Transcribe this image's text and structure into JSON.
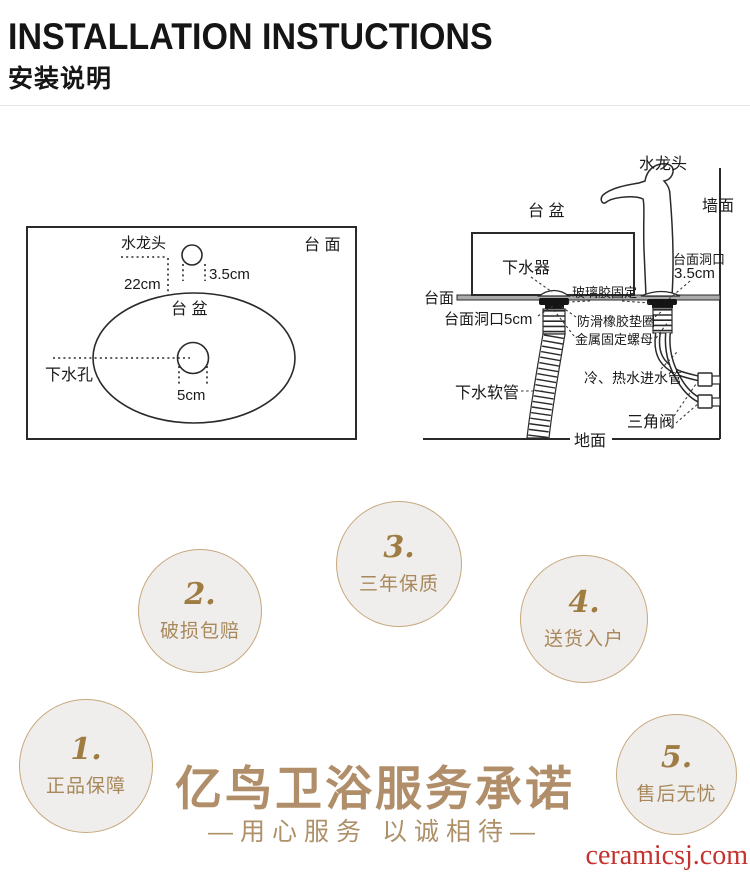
{
  "header": {
    "title": "INSTALLATION INSTUCTIONS",
    "subtitle": "安装说明"
  },
  "left_diagram": {
    "countertop_label": "台 面",
    "faucet_label": "水龙头",
    "faucet_hole_size": "3.5cm",
    "faucet_distance": "22cm",
    "basin_label": "台 盆",
    "drain_label": "下水孔",
    "drain_hole_size": "5cm"
  },
  "right_diagram": {
    "faucet_label": "水龙头",
    "wall_label": "墙面",
    "basin_label": "台 盆",
    "drain_fitting_label": "下水器",
    "glue_label": "玻璃胶固定",
    "countertop_label": "台面",
    "faucet_hole_label_line1": "台面洞口",
    "faucet_hole_label_line2": "3.5cm",
    "drain_hole_label": "台面洞口5cm",
    "washer_label": "防滑橡胶垫圈",
    "nut_label": "金属固定螺母",
    "drain_hose_label": "下水软管",
    "supply_pipe_label": "冷、热水进水管",
    "valve_label": "三角阀",
    "floor_label": "地面"
  },
  "badges": [
    {
      "num": "1.",
      "label": "正品保障"
    },
    {
      "num": "2.",
      "label": "破损包赔"
    },
    {
      "num": "3.",
      "label": "三年保质"
    },
    {
      "num": "4.",
      "label": "送货入户"
    },
    {
      "num": "5.",
      "label": "售后无忧"
    }
  ],
  "promise": {
    "title": "亿鸟卫浴服务承诺",
    "subtitle": "—用心服务  以诚相待—"
  },
  "watermark": "ceramicsj.com",
  "colors": {
    "gold_text": "#b18e6a",
    "badge_number": "#9f7c42",
    "badge_border": "#c7a87c",
    "badge_fill": "#efeeed",
    "watermark_red": "#c4332f"
  }
}
